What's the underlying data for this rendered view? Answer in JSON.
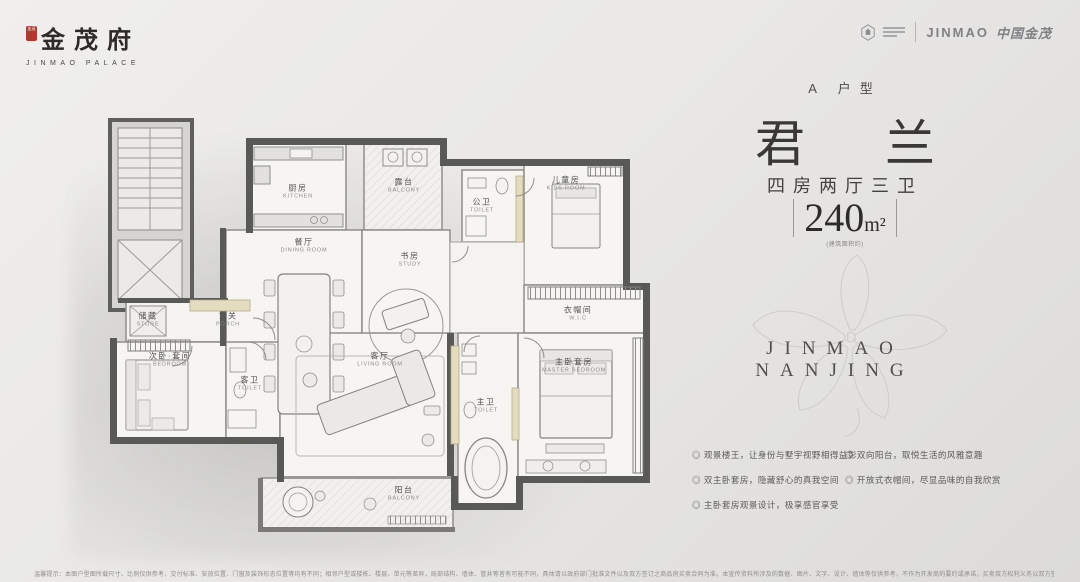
{
  "brand": {
    "seal": "金茂",
    "name": "金茂府",
    "sub": "JINMAO PALACE"
  },
  "partner": {
    "jinmao_en": "JINMAO",
    "jinmao_cn": "中国金茂"
  },
  "unit": {
    "type": "A 户型",
    "name_char1": "君",
    "name_char2": "兰",
    "layout": "四房两厅三卫",
    "area_value": "240",
    "area_unit": "m²",
    "area_note": "(建筑面积约)"
  },
  "watermark": {
    "text": "JINMAO NANJING"
  },
  "features": {
    "col1": [
      "◎ 观景楼王，让身份与墅宇视野相得益彰",
      "◎ 双主卧套房，隐藏舒心的真我空间",
      "◎ 主卧套房观景设计，极享感官享受"
    ],
    "col2": [
      "◎ 双向阳台，取悦生活的风雅意趣",
      "◎ 开放式衣帽间，尽显品味的自我欣赏"
    ]
  },
  "disclaimer": "温馨提示：本图户型图所载尺寸、比例仅供参考，交付标准、安放位置、门窗及装饰形态位置等均有不同；相邻户型或楼栋、楼层、单元等差异，局部结构、墙体、管井等皆有可能不同，具体请以政府部门批准文件以及双方签订之商品房买卖合同为准。本宣传资料所涉及的数据、图片、文字、设计、墙体等仅供参考，不作为开发商的要约或承诺，买卖双方权利义务以双方签订的商品房买卖合同及其附件为准，本资料在制作过程中已力求准确，如有误差以实际交付及政府部门最终批准文件为准。",
  "floorplan": {
    "rooms": [
      {
        "zh": "厨房",
        "en": "KITCHEN"
      },
      {
        "zh": "露台",
        "en": "BALCONY"
      },
      {
        "zh": "餐厅",
        "en": "DINING ROOM"
      },
      {
        "zh": "书房",
        "en": "STUDY"
      },
      {
        "zh": "公卫",
        "en": "TOILET"
      },
      {
        "zh": "儿童房",
        "en": "KIDS ROOM"
      },
      {
        "zh": "衣帽间",
        "en": "W.I.C"
      },
      {
        "zh": "储藏",
        "en": "STORE"
      },
      {
        "zh": "玄关",
        "en": "PORCH"
      },
      {
        "zh": "次卧·套间",
        "en": "BEDROOM"
      },
      {
        "zh": "客卫",
        "en": "TOILET"
      },
      {
        "zh": "客厅",
        "en": "LIVING ROOM"
      },
      {
        "zh": "主卫",
        "en": "TOILET"
      },
      {
        "zh": "主卧套房",
        "en": "MASTER BEDROOM"
      },
      {
        "zh": "阳台",
        "en": "BALCONY"
      }
    ]
  }
}
